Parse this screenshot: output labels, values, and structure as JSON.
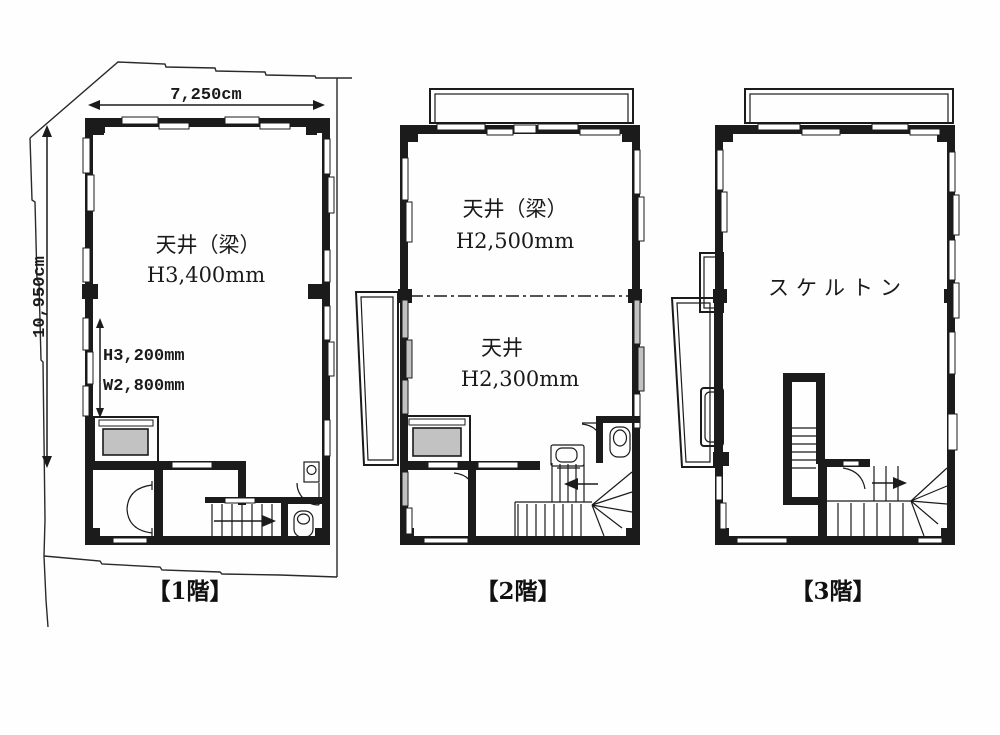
{
  "site": {
    "width_label": "7,250cm",
    "height_label": "10,950cm"
  },
  "floors": [
    {
      "label": "【1階】",
      "ceiling_label": "天井（梁）",
      "ceiling_height": "H3,400mm",
      "opening_height": "H3,200mm",
      "opening_width": "W2,800mm"
    },
    {
      "label": "【2階】",
      "upper_ceiling_label": "天井（梁）",
      "upper_ceiling_height": "H2,500mm",
      "lower_ceiling_label": "天井",
      "lower_ceiling_height": "H2,300mm"
    },
    {
      "label": "【3階】",
      "area_label": "スケルトン"
    }
  ],
  "colors": {
    "line": "#1b1b1b",
    "elevator_gray": "#c2c2c2",
    "background": "#ffffff"
  }
}
